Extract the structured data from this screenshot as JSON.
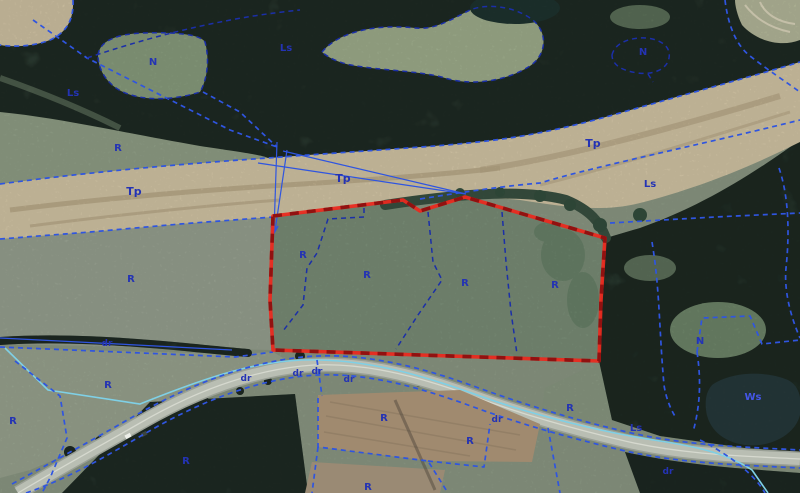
{
  "map": {
    "selected_parcel": {
      "outline_style": "red solid with dark-red dashes",
      "interior_labels": [
        "R",
        "R",
        "R",
        "R"
      ]
    }
  },
  "colors": {
    "parcel_boundary_blue": "#2f55e0",
    "parcel_boundary_navy": "#1b2fa8",
    "selected_parcel_red": "#ea2a1f",
    "selected_parcel_dash_dark": "#911110",
    "water_line_cyan": "#7fd0e6",
    "label_blue": "#2433b4",
    "forest_green": "#40584a",
    "field_green": "#8f9c87",
    "bare_soil_tan": "#d9cbaa",
    "road_gray": "#b9beb3",
    "pond_dark": "#273a3c",
    "plowed_field_brown": "#a08a6f"
  },
  "labels": [
    {
      "text": "N",
      "x": 153,
      "y": 62
    },
    {
      "text": "Ls",
      "x": 73,
      "y": 93
    },
    {
      "text": "R",
      "x": 118,
      "y": 148
    },
    {
      "text": "Ls",
      "x": 286,
      "y": 48
    },
    {
      "text": "N",
      "x": 643,
      "y": 52
    },
    {
      "text": "Tp",
      "x": 134,
      "y": 192
    },
    {
      "text": "Tp",
      "x": 343,
      "y": 179
    },
    {
      "text": "Tp",
      "x": 593,
      "y": 144
    },
    {
      "text": "Ls",
      "x": 650,
      "y": 184
    },
    {
      "text": "R",
      "x": 131,
      "y": 279
    },
    {
      "text": "R",
      "x": 303,
      "y": 255
    },
    {
      "text": "R",
      "x": 367,
      "y": 275
    },
    {
      "text": "R",
      "x": 465,
      "y": 283
    },
    {
      "text": "R",
      "x": 555,
      "y": 285
    },
    {
      "text": "dr",
      "x": 107,
      "y": 343
    },
    {
      "text": "R",
      "x": 108,
      "y": 385
    },
    {
      "text": "R",
      "x": 13,
      "y": 421
    },
    {
      "text": "dr",
      "x": 246,
      "y": 378
    },
    {
      "text": "dr",
      "x": 298,
      "y": 373
    },
    {
      "text": "dr",
      "x": 317,
      "y": 371
    },
    {
      "text": "dr",
      "x": 349,
      "y": 379
    },
    {
      "text": "R",
      "x": 384,
      "y": 418
    },
    {
      "text": "dr",
      "x": 497,
      "y": 419
    },
    {
      "text": "R",
      "x": 470,
      "y": 441
    },
    {
      "text": "R",
      "x": 186,
      "y": 461
    },
    {
      "text": "R",
      "x": 368,
      "y": 487
    },
    {
      "text": "N",
      "x": 700,
      "y": 341
    },
    {
      "text": "Ws",
      "x": 753,
      "y": 397
    },
    {
      "text": "R",
      "x": 570,
      "y": 408
    },
    {
      "text": "Ls",
      "x": 636,
      "y": 428
    },
    {
      "text": "dr",
      "x": 668,
      "y": 471
    }
  ]
}
